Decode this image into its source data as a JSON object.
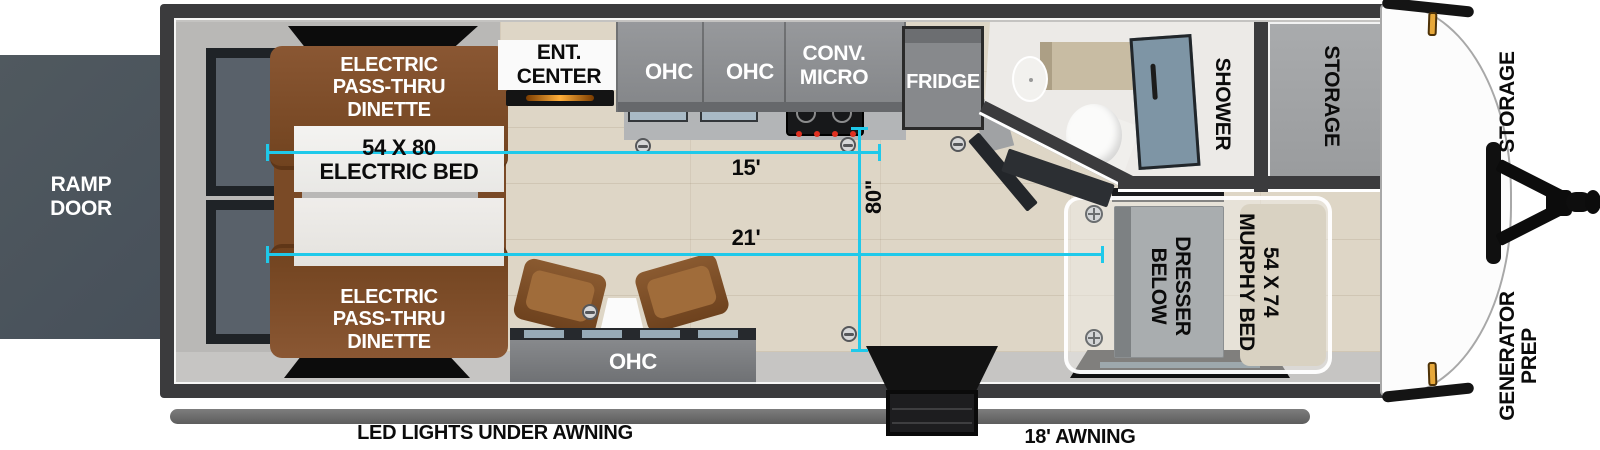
{
  "exterior": {
    "ramp_door": "RAMP\nDOOR",
    "storage": "STORAGE",
    "generator_prep": "GENERATOR\nPREP",
    "led_lights": "LED LIGHTS UNDER AWNING",
    "awning": "18' AWNING"
  },
  "living_area": {
    "dinette_front": "ELECTRIC\nPASS-THRU\nDINETTE",
    "dinette_rear": "ELECTRIC\nPASS-THRU\nDINETTE",
    "electric_bed": "54 X 80\nELECTRIC BED",
    "ent_center": "ENT.\nCENTER",
    "sofa_ohc": "OHC"
  },
  "kitchen": {
    "ohc_1": "OHC",
    "ohc_2": "OHC",
    "conv_micro": "CONV.\nMICRO",
    "fridge": "FRIDGE"
  },
  "bathroom": {
    "shower": "SHOWER",
    "storage": "STORAGE"
  },
  "bedroom": {
    "murphy_bed": "54 X 74\nMURPHY BED",
    "dresser": "DRESSER\nBELOW"
  },
  "measurements": {
    "galley_length": "15'",
    "main_length": "21'",
    "interior_width": "80\""
  },
  "colors": {
    "dimension_line": "#1fc9ea",
    "wall": "#3b3b3d",
    "floor": "#ded6c6",
    "dinette": "#7d4b27",
    "cabinet": "#8f9194",
    "ramp_door": "#4b545c",
    "shower_glass": "#7e95a5",
    "marker_light": "#e7a83a"
  }
}
